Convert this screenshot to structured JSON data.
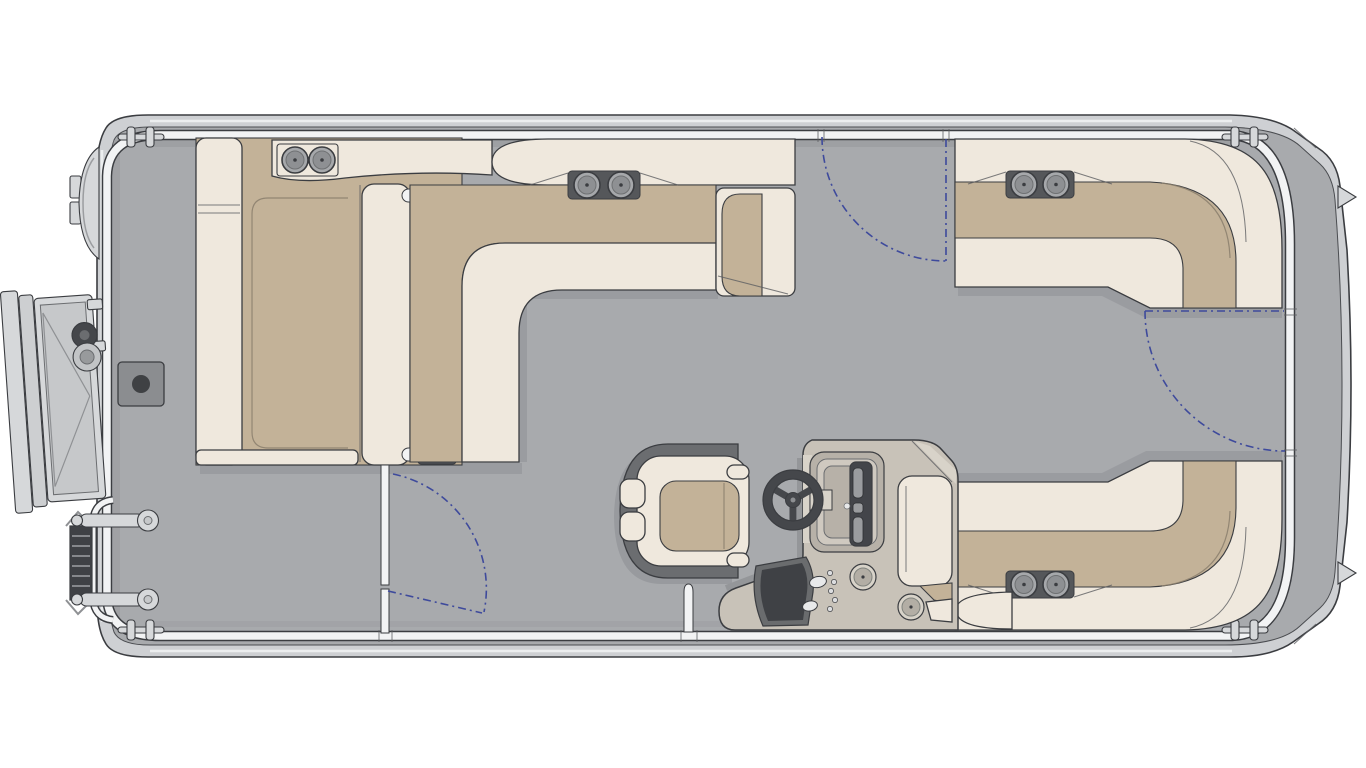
{
  "diagram": {
    "type": "pontoon-boat-floor-plan-top-view",
    "orientation": {
      "bow": "right",
      "stern": "left"
    },
    "canvas": {
      "width": 1366,
      "height": 768
    },
    "colors": {
      "background": "#ffffff",
      "hull": "#ced0d3",
      "hullLine": "#3b3d41",
      "deck": "#a8aaad",
      "fence": "#f2f3f4",
      "cream": "#efe8dd",
      "tan": "#c3b298",
      "plate": "#55575a",
      "cupRing": "#a6a8ab",
      "cupInner": "#8e9093",
      "console": "#c8c2b8",
      "consoleLight": "#d8d3c9",
      "consoleDark": "#45474b",
      "chairDark": "#6b6d70",
      "shadow": "#94969a",
      "gate": "#3e4a9c",
      "hardware": "#d6d8da"
    },
    "components": {
      "hull": {
        "shape": "rounded-pontoon-deck",
        "mooring_cleats": 4,
        "bow_spray_fins": 2
      },
      "stern_features": {
        "outboard_motor": true,
        "open_boarding_gate": true,
        "folded_boarding_ladder": true,
        "grab_handles": 2,
        "table_pedestal_base": true
      },
      "seating": [
        {
          "id": "port-stern-chaise",
          "cup_holders": 2
        },
        {
          "id": "port-l-lounge",
          "cup_holders": 2,
          "armrest": true,
          "flip_backrest_hinges": 2
        },
        {
          "id": "bow-port-l-lounge",
          "cup_holders": 2
        },
        {
          "id": "bow-starboard-l-lounge",
          "cup_holders": 2
        },
        {
          "id": "captain-chair",
          "headrest_pads": 2
        }
      ],
      "helm": {
        "steering_wheel": true,
        "instrument_cluster": true,
        "switch_panel": true,
        "gauge_speakers": 2,
        "companion_seat_back": true
      },
      "gates": [
        {
          "id": "port-bow-gate",
          "swing": "dashed-arc"
        },
        {
          "id": "bow-center-gate",
          "swing": "dashed-arc"
        },
        {
          "id": "port-stern-gate",
          "swing": "dashed-arc",
          "post": true
        }
      ]
    }
  }
}
